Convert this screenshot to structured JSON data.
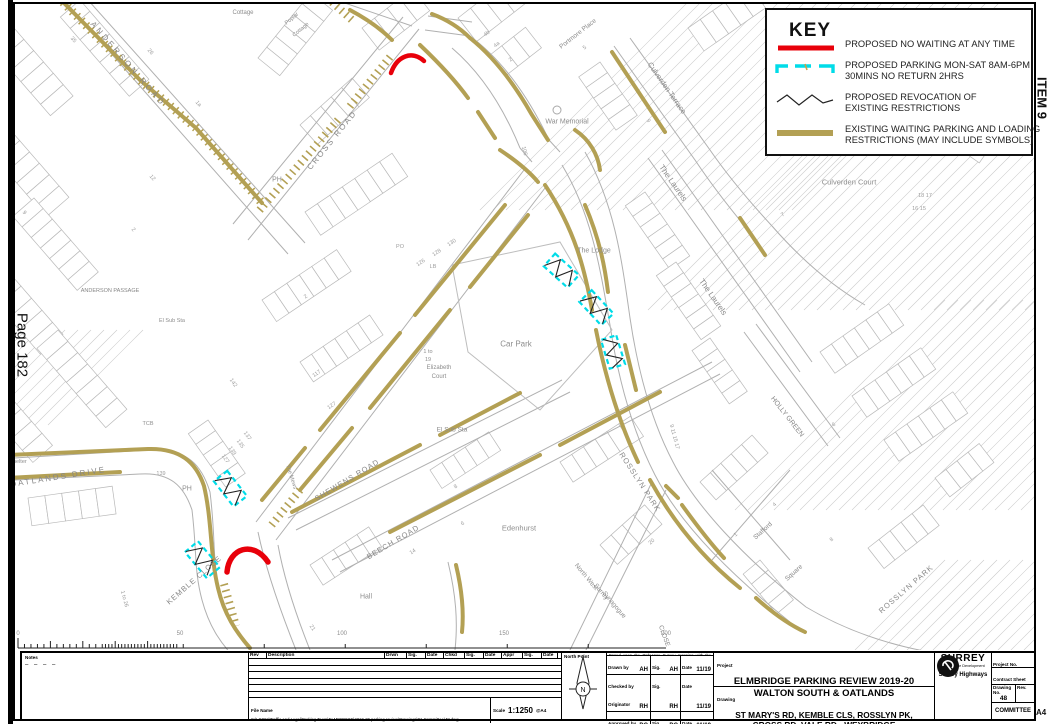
{
  "page": {
    "left_page_label": "Page 182",
    "right_item_label": "ITEM 9",
    "corner_label": "A4"
  },
  "colors": {
    "proposed_no_waiting": "#e8000a",
    "proposed_parking": "#00dce8",
    "revocation": "#222222",
    "existing_restrictions": "#b3a054"
  },
  "key": {
    "title": "KEY",
    "items": [
      {
        "id": "no-waiting",
        "lines": [
          "PROPOSED NO WAITING AT ANY TIME"
        ]
      },
      {
        "id": "parking-bay",
        "lines": [
          "PROPOSED PARKING MON-SAT 8AM-6PM",
          "30MINS NO RETURN 2HRS"
        ]
      },
      {
        "id": "revocation",
        "lines": [
          "PROPOSED REVOCATION OF",
          "EXISTING RESTRICTIONS"
        ]
      },
      {
        "id": "existing",
        "lines": [
          "EXISTING WAITING PARKING AND LOADING",
          "RESTRICTIONS (MAY INCLUDE SYMBOLS)"
        ]
      }
    ]
  },
  "map": {
    "street_labels": [
      {
        "t": "ANDERSON ROAD",
        "x": 128,
        "y": 64,
        "r": 49,
        "s": 8,
        "sp": 3
      },
      {
        "t": "CROSS ROAD",
        "x": 332,
        "y": 140,
        "r": -51,
        "s": 8,
        "sp": 2
      },
      {
        "t": "OATLANDS DRIVE",
        "x": 58,
        "y": 477,
        "r": -9,
        "s": 8,
        "sp": 2
      },
      {
        "t": "KEMBLE CLOSE",
        "x": 194,
        "y": 580,
        "r": -41,
        "s": 7.5,
        "sp": 1
      },
      {
        "t": "SHEWENS ROAD",
        "x": 347,
        "y": 480,
        "r": -31,
        "s": 7.5,
        "sp": 1
      },
      {
        "t": "BEECH ROAD",
        "x": 393,
        "y": 542,
        "r": -31,
        "s": 7.5,
        "sp": 1
      },
      {
        "t": "ROSSLYN PARK",
        "x": 640,
        "y": 482,
        "r": 57,
        "s": 7.5,
        "sp": 1
      },
      {
        "t": "ROSSLYN PARK",
        "x": 906,
        "y": 589,
        "r": -41,
        "s": 7.5,
        "sp": 1
      },
      {
        "t": "The Laurels",
        "x": 673,
        "y": 183,
        "r": 55,
        "s": 8
      },
      {
        "t": "The Laurels",
        "x": 713,
        "y": 297,
        "r": 55,
        "s": 8
      },
      {
        "t": "Culverden Terrace",
        "x": 667,
        "y": 88,
        "r": 55,
        "s": 7.5
      },
      {
        "t": "HOLLY GREEN",
        "x": 787,
        "y": 417,
        "r": 52,
        "s": 7
      },
      {
        "t": "Stafford",
        "x": 763,
        "y": 531,
        "r": -42,
        "s": 6.5
      },
      {
        "t": "Square",
        "x": 794,
        "y": 573,
        "r": -42,
        "s": 6.5
      },
      {
        "t": "CLOSE",
        "x": 664,
        "y": 636,
        "r": 70,
        "s": 6.5
      },
      {
        "t": "ANDERSON PASSAGE",
        "x": 110,
        "y": 291,
        "r": 0,
        "s": 5.5
      }
    ],
    "place_labels": [
      {
        "t": "War Memorial",
        "x": 567,
        "y": 122,
        "s": 7
      },
      {
        "t": "Portmore Place",
        "x": 578,
        "y": 34,
        "r": -38,
        "s": 6.5
      },
      {
        "t": "Culverden Court",
        "x": 849,
        "y": 182,
        "s": 7.5
      },
      {
        "t": "The Lodge",
        "x": 594,
        "y": 251,
        "s": 7
      },
      {
        "t": "Car Park",
        "x": 516,
        "y": 344,
        "s": 8
      },
      {
        "t": "El Sub Sta",
        "x": 452,
        "y": 430,
        "s": 6.5
      },
      {
        "t": "El Sub Sta",
        "x": 172,
        "y": 321,
        "s": 5.5
      },
      {
        "t": "Edenhurst",
        "x": 519,
        "y": 528,
        "s": 7.5
      },
      {
        "t": "Hall",
        "x": 366,
        "y": 597,
        "s": 7
      },
      {
        "t": "Shelter",
        "x": 18,
        "y": 462,
        "s": 5.5
      },
      {
        "t": "PH",
        "x": 277,
        "y": 180,
        "s": 7
      },
      {
        "t": "PH",
        "x": 187,
        "y": 489,
        "s": 7
      },
      {
        "t": "The Mews",
        "x": 291,
        "y": 477,
        "r": 72,
        "s": 5.5
      },
      {
        "t": "TCB",
        "x": 148,
        "y": 424,
        "s": 5.5
      },
      {
        "t": "North West",
        "x": 586,
        "y": 577,
        "r": 50,
        "s": 6.5
      },
      {
        "t": "Surrey",
        "x": 601,
        "y": 592,
        "r": 50,
        "s": 6.5
      },
      {
        "t": "Synagogue",
        "x": 614,
        "y": 605,
        "r": 50,
        "s": 6.5
      },
      {
        "t": "1 to",
        "x": 428,
        "y": 352,
        "s": 5.5
      },
      {
        "t": "19",
        "x": 428,
        "y": 360,
        "s": 5.5
      },
      {
        "t": "Elizabeth",
        "x": 439,
        "y": 368,
        "s": 6
      },
      {
        "t": "Court",
        "x": 439,
        "y": 377,
        "s": 6
      },
      {
        "t": "Cottage",
        "x": 243,
        "y": 13,
        "s": 6
      },
      {
        "t": "Poplar",
        "x": 292,
        "y": 19,
        "r": -40,
        "s": 5.5
      },
      {
        "t": "Cottage",
        "x": 301,
        "y": 30,
        "r": -40,
        "s": 5.5
      }
    ],
    "house_numbers": [
      {
        "t": "35",
        "x": 73,
        "y": 40,
        "r": 49
      },
      {
        "t": "26",
        "x": 150,
        "y": 52,
        "r": 49
      },
      {
        "t": "9",
        "x": 24,
        "y": 213,
        "r": 49
      },
      {
        "t": "1a",
        "x": 198,
        "y": 104,
        "r": 49
      },
      {
        "t": "12",
        "x": 152,
        "y": 178,
        "r": 49
      },
      {
        "t": "2",
        "x": 133,
        "y": 230,
        "r": 49
      },
      {
        "t": "4b",
        "x": 487,
        "y": 34,
        "r": -38
      },
      {
        "t": "4a",
        "x": 497,
        "y": 45,
        "r": -38
      },
      {
        "t": "2",
        "x": 511,
        "y": 60,
        "r": -38
      },
      {
        "t": "5",
        "x": 585,
        "y": 48,
        "r": -38
      },
      {
        "t": "106",
        "x": 524,
        "y": 151,
        "r": 75
      },
      {
        "t": "130",
        "x": 452,
        "y": 243,
        "r": -34
      },
      {
        "t": "128",
        "x": 437,
        "y": 253,
        "r": -34
      },
      {
        "t": "126",
        "x": 421,
        "y": 263,
        "r": -34
      },
      {
        "t": "PO",
        "x": 400,
        "y": 247,
        "r": 0
      },
      {
        "t": "LB",
        "x": 433,
        "y": 267,
        "r": 0
      },
      {
        "t": "2",
        "x": 306,
        "y": 297,
        "r": -34
      },
      {
        "t": "117",
        "x": 317,
        "y": 374,
        "r": -34
      },
      {
        "t": "127",
        "x": 332,
        "y": 406,
        "r": -34
      },
      {
        "t": "142",
        "x": 233,
        "y": 383,
        "r": 55
      },
      {
        "t": "137",
        "x": 247,
        "y": 436,
        "r": 55
      },
      {
        "t": "135",
        "x": 240,
        "y": 444,
        "r": 55
      },
      {
        "t": "139",
        "x": 232,
        "y": 451,
        "r": 55
      },
      {
        "t": "127",
        "x": 225,
        "y": 459,
        "r": 55
      },
      {
        "t": "139",
        "x": 161,
        "y": 474,
        "r": 0
      },
      {
        "t": "1 to 26",
        "x": 124,
        "y": 599,
        "r": 75
      },
      {
        "t": "21",
        "x": 312,
        "y": 628,
        "r": 55
      },
      {
        "t": "8",
        "x": 456,
        "y": 487,
        "r": -34
      },
      {
        "t": "6",
        "x": 463,
        "y": 524,
        "r": -34
      },
      {
        "t": "14",
        "x": 413,
        "y": 552,
        "r": -34
      },
      {
        "t": "20",
        "x": 652,
        "y": 542,
        "r": -42
      },
      {
        "t": "18 17",
        "x": 925,
        "y": 196,
        "r": 0
      },
      {
        "t": "16 15",
        "x": 919,
        "y": 209,
        "r": 0
      },
      {
        "t": "9 11 15 17",
        "x": 674,
        "y": 437,
        "r": 75
      },
      {
        "t": "6",
        "x": 834,
        "y": 425,
        "r": -35
      },
      {
        "t": "4",
        "x": 775,
        "y": 505,
        "r": -42
      },
      {
        "t": "1",
        "x": 736,
        "y": 535,
        "r": -42
      },
      {
        "t": "8",
        "x": 832,
        "y": 540,
        "r": -42
      },
      {
        "t": "9",
        "x": 648,
        "y": 121,
        "r": 55
      },
      {
        "t": "7",
        "x": 783,
        "y": 215,
        "r": -35
      }
    ]
  },
  "scale_bar": {
    "labels": [
      {
        "t": "0",
        "x": 18
      },
      {
        "t": "50",
        "x": 180
      },
      {
        "t": "100",
        "x": 342
      },
      {
        "t": "150",
        "x": 504
      },
      {
        "t": "200",
        "x": 666
      }
    ]
  },
  "title_block": {
    "notes_label": "Notes",
    "notes_dashes": "– – – –",
    "rev_headers": [
      "Rev",
      "Description",
      "Drwn",
      "Sig.",
      "Date",
      "Chkd",
      "Sig.",
      "Date",
      "Appr",
      "Sig.",
      "Date"
    ],
    "file_name_label": "File Name",
    "file_name": "S:\\LG062\\Traffic and Legal\\Parking Team\\ELMBRIDGE\\2019-20 parking review\\Drawings\\01 Committee\\48.dwg",
    "scale_label": "Scale",
    "scale_value": "1:1250",
    "paper": "@A4",
    "north_point_label": "North Point",
    "north_letter": "N",
    "copyright": "Based upon the Ordnance Survey mapping with the permission of the Controller of Her Majesty's Stationery Office © Crown copyright. Unauthorised reproduction infringes Crown copyright and may lead to prosecution or civil proceedings. Surrey County Council. LA 076872. 2019.",
    "sig_col_labels": {
      "sig": "Sig.",
      "date": "Date"
    },
    "signatures": [
      {
        "role": "Drawn by",
        "name": "AH",
        "sig": "AH",
        "date": "11/19"
      },
      {
        "role": "Checked by Originator",
        "name": "RH",
        "sig": "RH",
        "date": "11/19"
      },
      {
        "role": "Approved by",
        "name": "DC",
        "sig": "DC",
        "date": "11/19"
      }
    ],
    "project_label": "Project",
    "project_line1": "ELMBRIDGE PARKING REVIEW 2019-20",
    "project_line2": "WALTON SOUTH & OATLANDS",
    "drawing_label": "Drawing",
    "drawing_line1": "ST MARY'S RD, KEMBLE CLS, ROSSLYN PK,",
    "drawing_line2": "CROSS RD, VALE RD - WEYBRIDGE",
    "sheet_of": "SHEET  OF",
    "org": {
      "name": "SURREY",
      "tagline": "Sustainable Development",
      "dept": "Surrey Highways"
    },
    "fields": {
      "project_no_label": "Project No.",
      "contract_label": "Contract Sheet No.",
      "drawing_no_label": "Drawing No.",
      "drawing_no": "48",
      "rev_label": "Rev.",
      "committee": "COMMITTEE"
    }
  }
}
